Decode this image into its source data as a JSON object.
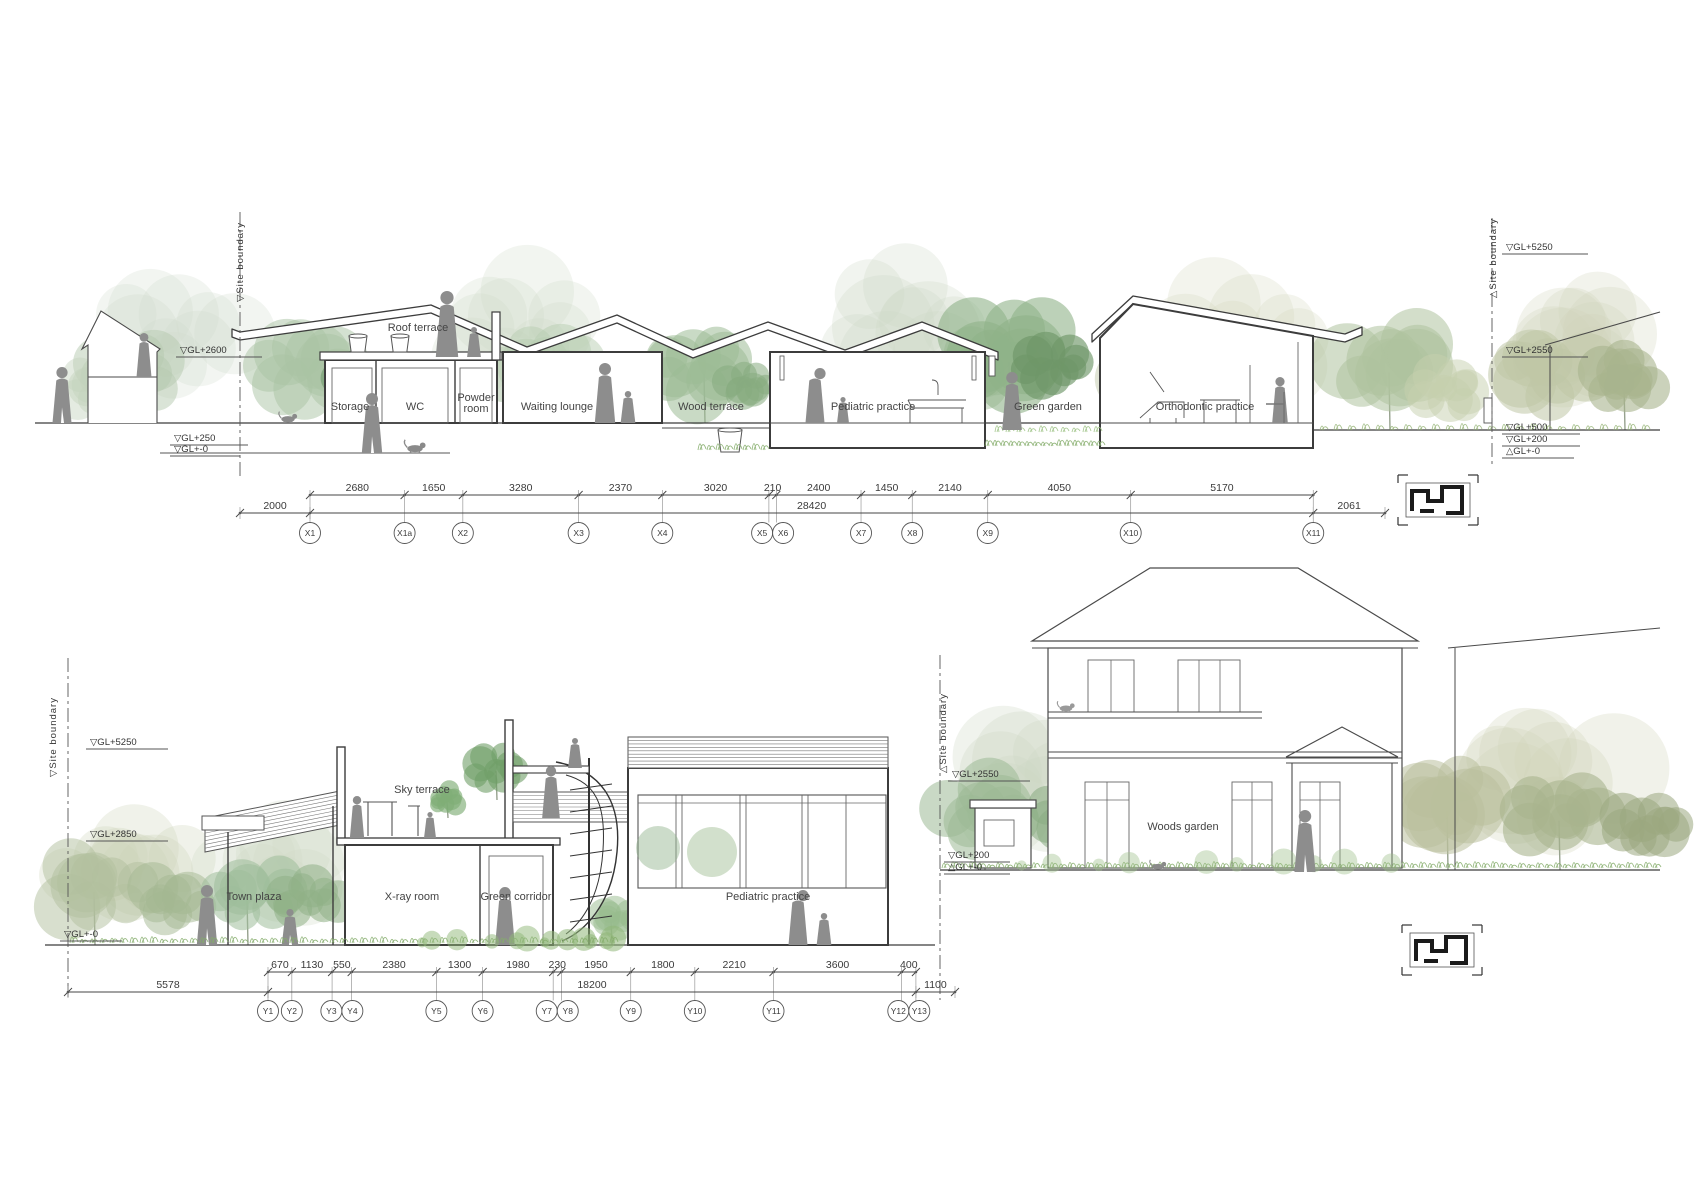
{
  "top": {
    "site_boundary_left": "▽Site  boundary",
    "site_boundary_right": "△Site  boundary",
    "levels_left": [
      "▽GL+2600",
      "▽GL+250",
      "▽GL+-0"
    ],
    "levels_right": [
      "▽GL+5250",
      "▽GL+2550",
      "▽GL+500",
      "▽GL+200",
      "△GL+-0"
    ],
    "room_labels": [
      "Roof terrace",
      "Storage",
      "WC",
      "Powder room",
      "Waiting lounge",
      "Wood terrace",
      "Pediatric practice",
      "Green garden",
      "Orthodontic practice"
    ],
    "dims": [
      "2680",
      "1650",
      "3280",
      "2370",
      "3020",
      "210",
      "2400",
      "1450",
      "2140",
      "4050",
      "5170"
    ],
    "dims_mm": [
      2680,
      1650,
      3280,
      2370,
      3020,
      210,
      2400,
      1450,
      2140,
      4050,
      5170
    ],
    "overall_dims": {
      "left": "2000",
      "total": "28420",
      "right": "2061"
    },
    "grid_labels": [
      "X1",
      "X1a",
      "X2",
      "X3",
      "X4",
      "X5",
      "X6",
      "X7",
      "X8",
      "X9",
      "X10",
      "X11"
    ]
  },
  "bottom": {
    "site_boundary_left": "▽Site  boundary",
    "site_boundary_right": "△Site  boundary",
    "levels_left": [
      "▽GL+5250",
      "▽GL+2850",
      "▽GL+-0"
    ],
    "levels_right": [
      "▽GL+2550",
      "▽GL+200",
      "△GL+-0"
    ],
    "room_labels": [
      "Sky terrace",
      "Town plaza",
      "X-ray room",
      "Green corridor",
      "Pediatric practice",
      "Woods garden"
    ],
    "dims": [
      "670",
      "1130",
      "550",
      "2380",
      "1300",
      "1980",
      "230",
      "1950",
      "1800",
      "2210",
      "3600",
      "400"
    ],
    "dims_mm": [
      670,
      1130,
      550,
      2380,
      1300,
      1980,
      230,
      1950,
      1800,
      2210,
      3600,
      400
    ],
    "overall_dims": {
      "left": "5578",
      "total": "18200",
      "right": "1100"
    },
    "grid_labels": [
      "Y1",
      "Y2",
      "Y3",
      "Y4",
      "Y5",
      "Y6",
      "Y7",
      "Y8",
      "Y9",
      "Y10",
      "Y11",
      "Y12",
      "Y13"
    ]
  }
}
